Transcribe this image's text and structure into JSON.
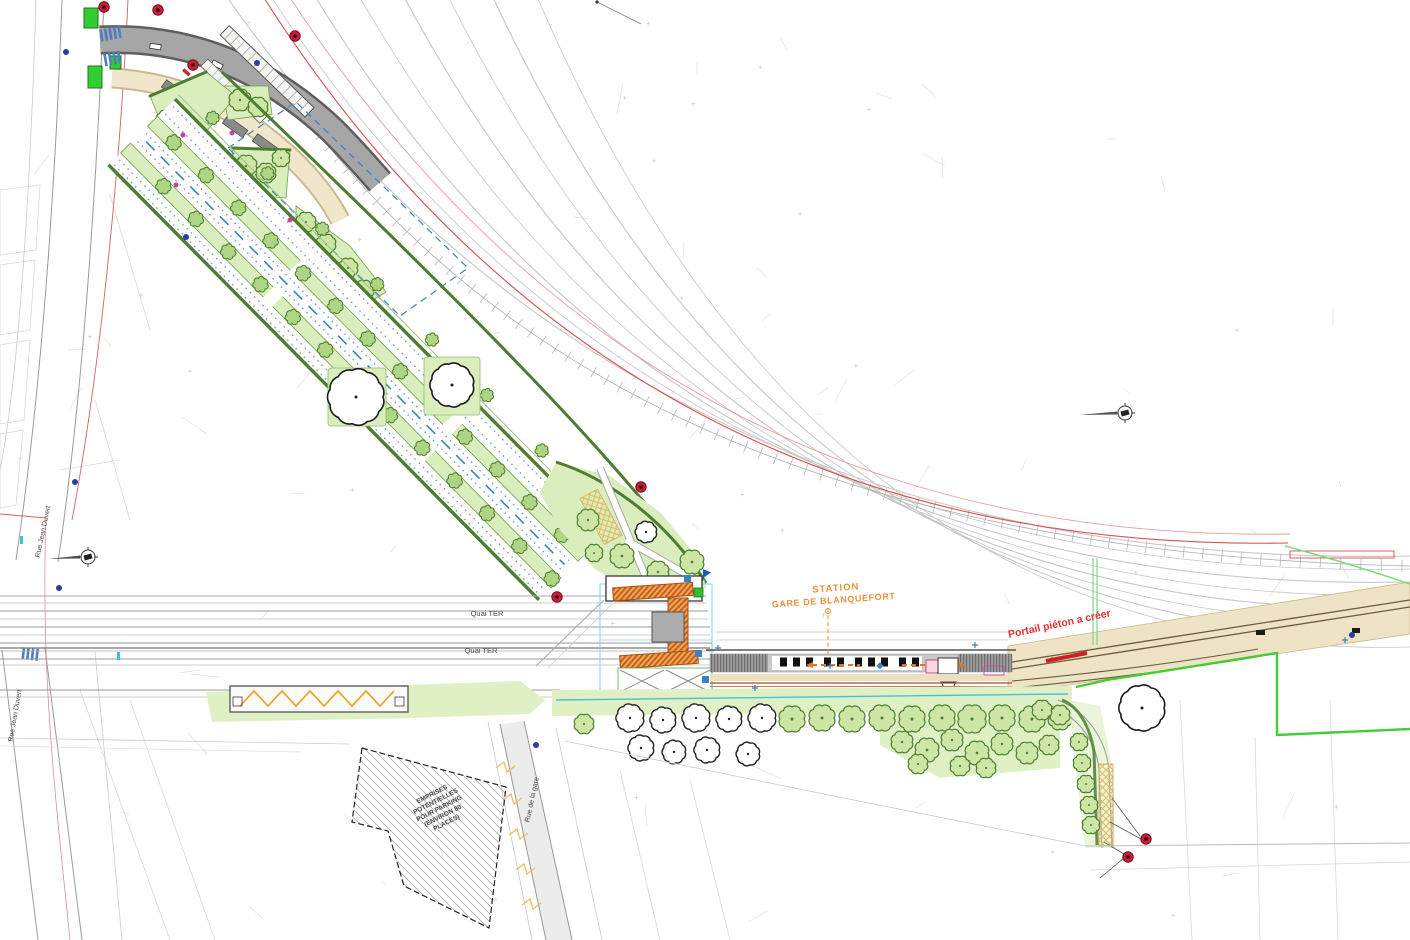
{
  "plan": {
    "station": {
      "line1": "STATION",
      "line2": "GARE DE BLANQUEFORT"
    },
    "annotations": {
      "portail_pieton": "Portail piéton a créer",
      "parking_l1": "EMPRISES",
      "parking_l2": "POTENTIELLES",
      "parking_l3": "POUR PARKING",
      "parking_l4": "(ENVIRON 80",
      "parking_l5": "PLACES)"
    },
    "streets": {
      "quai_ter_top": "Quai TER",
      "quai_ter_bottom": "Quai TER",
      "rue_jean_duvert_top": "Rue Jean Duvert",
      "rue_jean_duvert_bottom": "Rue Jean Duvert",
      "rue_de_la_gare": "Rue de la gare"
    }
  },
  "colors": {
    "station_label": "#E8923A",
    "annotation_red": "#E03030",
    "street_label": "#4A4A4A",
    "parking_note": "#444444",
    "boundary_green": "#44CC33",
    "hedge_green": "#4E7D32",
    "lawn_green": "#D9EDBD",
    "building_orange": "#C2601E",
    "road_tan": "#EFE3C6",
    "marker_blue": "#3B82C4"
  },
  "icons": {
    "traffic_sign": "red-circle-sign-icon",
    "survey_marker": "survey-benchmark-icon",
    "north_needle": "survey-needle-icon"
  }
}
